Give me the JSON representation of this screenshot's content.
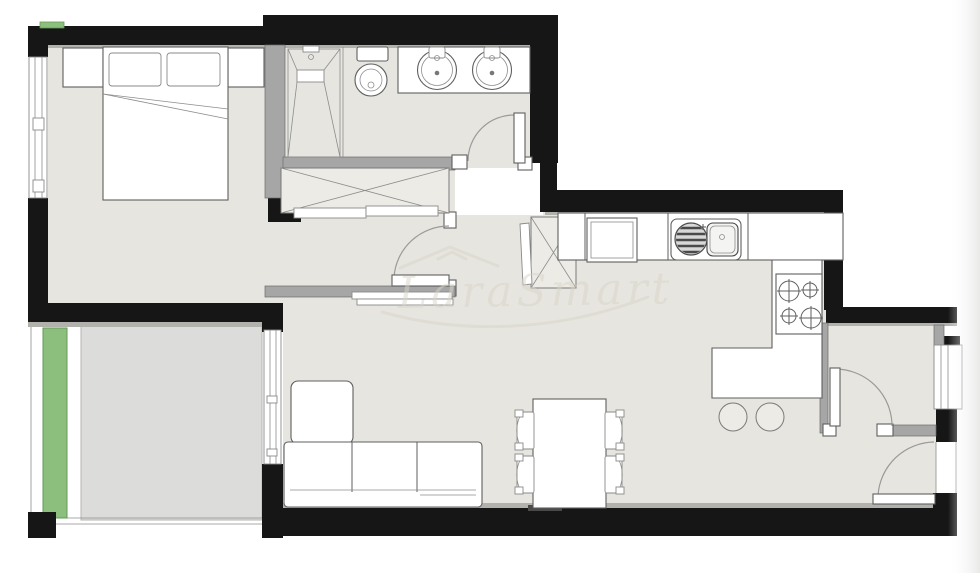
{
  "document": {
    "kind": "apartment-floor-plan",
    "watermark_text": "LaraSmart"
  },
  "colors": {
    "background": "#ffffff",
    "exterior_wall": "#161616",
    "interior_wall": "#a6a6a6",
    "floor": "#e7e5df",
    "terrace_floor": "#dcdcda",
    "planter_green": "#8cbe7d",
    "fixture_outline": "#5f5f5f",
    "watermark": "#d9d5c9"
  },
  "rooms": [
    {
      "id": "bedroom",
      "features": [
        "double-bed",
        "two-pillows",
        "nightstand-left",
        "nightstand-right",
        "window",
        "built-in-wardrobe",
        "dressing-corridor"
      ]
    },
    {
      "id": "bathroom",
      "features": [
        "walk-in-shower",
        "toilet",
        "double-sink-vanity",
        "hinged-door"
      ]
    },
    {
      "id": "living-dining",
      "features": [
        "corner-sofa",
        "tv-unit",
        "dining-table",
        "four-chairs",
        "sliding-door-to-terrace"
      ]
    },
    {
      "id": "kitchen",
      "features": [
        "fridge",
        "sink-with-drainer",
        "hob-four-burners",
        "breakfast-bar",
        "two-stools",
        "utility-shaft"
      ]
    },
    {
      "id": "entrance-hall",
      "features": [
        "entrance-door",
        "inner-door",
        "window"
      ]
    },
    {
      "id": "terrace",
      "features": [
        "planter-strip",
        "open-edge",
        "corner-post"
      ]
    }
  ]
}
